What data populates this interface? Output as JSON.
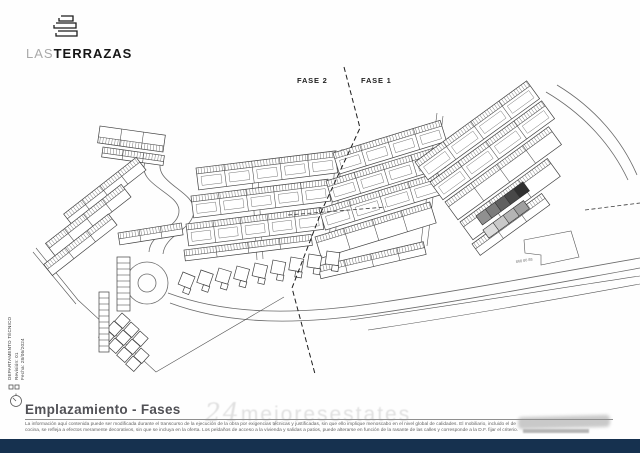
{
  "logo": {
    "word_light": "LAS",
    "word_bold": "TERRAZAS",
    "icon": "terraces-logo-icon"
  },
  "phases": {
    "fase2": "FASE 2",
    "fase1": "FASE 1"
  },
  "title": "Emplazamiento - Fases",
  "disclaimer": {
    "line1": "La información aquí contenida puede ser modificada durante el transcurso de la ejecución de la obra por exigencias técnicas y justificadas, sin que ello implique menoscabo en el nivel global de calidades. El mobiliario, incluido el de",
    "line2": "cocina, se refleja a efectos meramente decorativos, sin que se incluya en la oferta. Los peldaños de acceso a la vivienda y salidas a patios, puede alterarse en función de la rasante de las calles y corresponde a la D.F. fijar el criterio."
  },
  "sidebar": {
    "department": "DEPARTAMENTO TÉCNICO",
    "revision": "Revisión:   01",
    "date": "Fecha:   28/06/2024"
  },
  "watermark": {
    "prefix": "24",
    "text": "mejoresestates"
  },
  "road_number": "868 86 88",
  "colors": {
    "footer": "#16314f",
    "plan_line": "#404040",
    "logo_dark": "#161616"
  },
  "plan": {
    "bands": [
      {
        "x": 100,
        "y": 126,
        "a": 8,
        "len": 66,
        "w": 17,
        "c": 3,
        "h": "bottom"
      },
      {
        "x": 103,
        "y": 147,
        "a": 8,
        "len": 62,
        "w": 10,
        "c": 3,
        "h": "top"
      },
      {
        "x": 146,
        "y": 170,
        "a": 142,
        "len": 92,
        "w": 16,
        "c": 4,
        "h": "bottom"
      },
      {
        "x": 131,
        "y": 197,
        "a": 142,
        "len": 96,
        "w": 16,
        "c": 4,
        "h": "bottom"
      },
      {
        "x": 117,
        "y": 225,
        "a": 142,
        "len": 82,
        "w": 14,
        "c": 3,
        "h": "bottom"
      },
      {
        "x": 118,
        "y": 233,
        "a": -9,
        "len": 64,
        "w": 12,
        "c": 3,
        "h": "top"
      },
      {
        "x": 196,
        "y": 168,
        "a": -7,
        "len": 140,
        "w": 22,
        "c": 5,
        "h": "top",
        "inner": true
      },
      {
        "x": 191,
        "y": 196,
        "a": -7,
        "len": 138,
        "w": 22,
        "c": 5,
        "h": "top",
        "inner": true
      },
      {
        "x": 186,
        "y": 224,
        "a": -7,
        "len": 136,
        "w": 22,
        "c": 5,
        "h": "top",
        "inner": true
      },
      {
        "x": 184,
        "y": 250,
        "a": -7,
        "len": 128,
        "w": 11,
        "c": 4,
        "h": "top"
      },
      {
        "x": 333,
        "y": 153,
        "a": -17,
        "len": 112,
        "w": 22,
        "c": 4,
        "h": "top",
        "inner": true
      },
      {
        "x": 326,
        "y": 181,
        "a": -17,
        "len": 118,
        "w": 22,
        "c": 4,
        "h": "top",
        "inner": true
      },
      {
        "x": 319,
        "y": 209,
        "a": -17,
        "len": 124,
        "w": 22,
        "c": 4,
        "h": "top",
        "inner": true
      },
      {
        "x": 315,
        "y": 237,
        "a": -17,
        "len": 120,
        "w": 22,
        "c": 4,
        "h": "top"
      },
      {
        "x": 318,
        "y": 266,
        "a": -13,
        "len": 108,
        "w": 13,
        "c": 4,
        "h": "top"
      },
      {
        "x": 415,
        "y": 162,
        "a": -36,
        "len": 138,
        "w": 22,
        "c": 4,
        "h": "top",
        "inner": true
      },
      {
        "x": 430,
        "y": 182,
        "a": -36,
        "len": 138,
        "w": 22,
        "c": 4,
        "h": "top",
        "inner": true
      },
      {
        "x": 445,
        "y": 202,
        "a": -36,
        "len": 128,
        "w": 22,
        "c": 4,
        "h": "top"
      },
      {
        "x": 460,
        "y": 222,
        "a": -36,
        "len": 108,
        "w": 22,
        "c": 3,
        "h": "top"
      },
      {
        "x": 472,
        "y": 244,
        "a": -36,
        "len": 86,
        "w": 14,
        "c": 3,
        "h": "top"
      },
      {
        "x": 476,
        "y": 216,
        "a": -36,
        "len": 58,
        "w": 11,
        "c": 5,
        "fills": [
          "#909090",
          "#7b7b7b",
          "#606060",
          "#484848",
          "#303030"
        ]
      },
      {
        "x": 483,
        "y": 230,
        "a": -36,
        "len": 50,
        "w": 10,
        "c": 4,
        "fills": [
          "#dcdcdc",
          "#c9c9c9",
          "#b4b4b4",
          "#a0a0a0"
        ]
      }
    ],
    "cottages": [
      [
        183,
        272,
        22,
        13
      ],
      [
        201,
        270,
        19,
        13
      ],
      [
        219,
        268,
        17,
        13
      ],
      [
        237,
        266,
        15,
        13
      ],
      [
        255,
        263,
        13,
        13
      ],
      [
        273,
        260,
        11,
        13
      ],
      [
        291,
        257,
        10,
        13
      ],
      [
        309,
        254,
        9,
        13
      ],
      [
        327,
        251,
        8,
        13
      ]
    ],
    "cluster_squares": [
      [
        106,
        329,
        42,
        11
      ],
      [
        115,
        338,
        42,
        11
      ],
      [
        124,
        347,
        42,
        11
      ],
      [
        133,
        356,
        42,
        11
      ],
      [
        114,
        321,
        42,
        11
      ],
      [
        123,
        330,
        42,
        11
      ],
      [
        132,
        339,
        42,
        11
      ],
      [
        141,
        348,
        42,
        11
      ],
      [
        122,
        313,
        42,
        11
      ],
      [
        131,
        322,
        42,
        11
      ],
      [
        140,
        331,
        42,
        11
      ]
    ],
    "ladders": [
      {
        "x": 117,
        "y": 257,
        "w": 13,
        "h": 54,
        "n": 9
      },
      {
        "x": 99,
        "y": 292,
        "w": 10,
        "h": 60,
        "n": 10
      }
    ]
  }
}
